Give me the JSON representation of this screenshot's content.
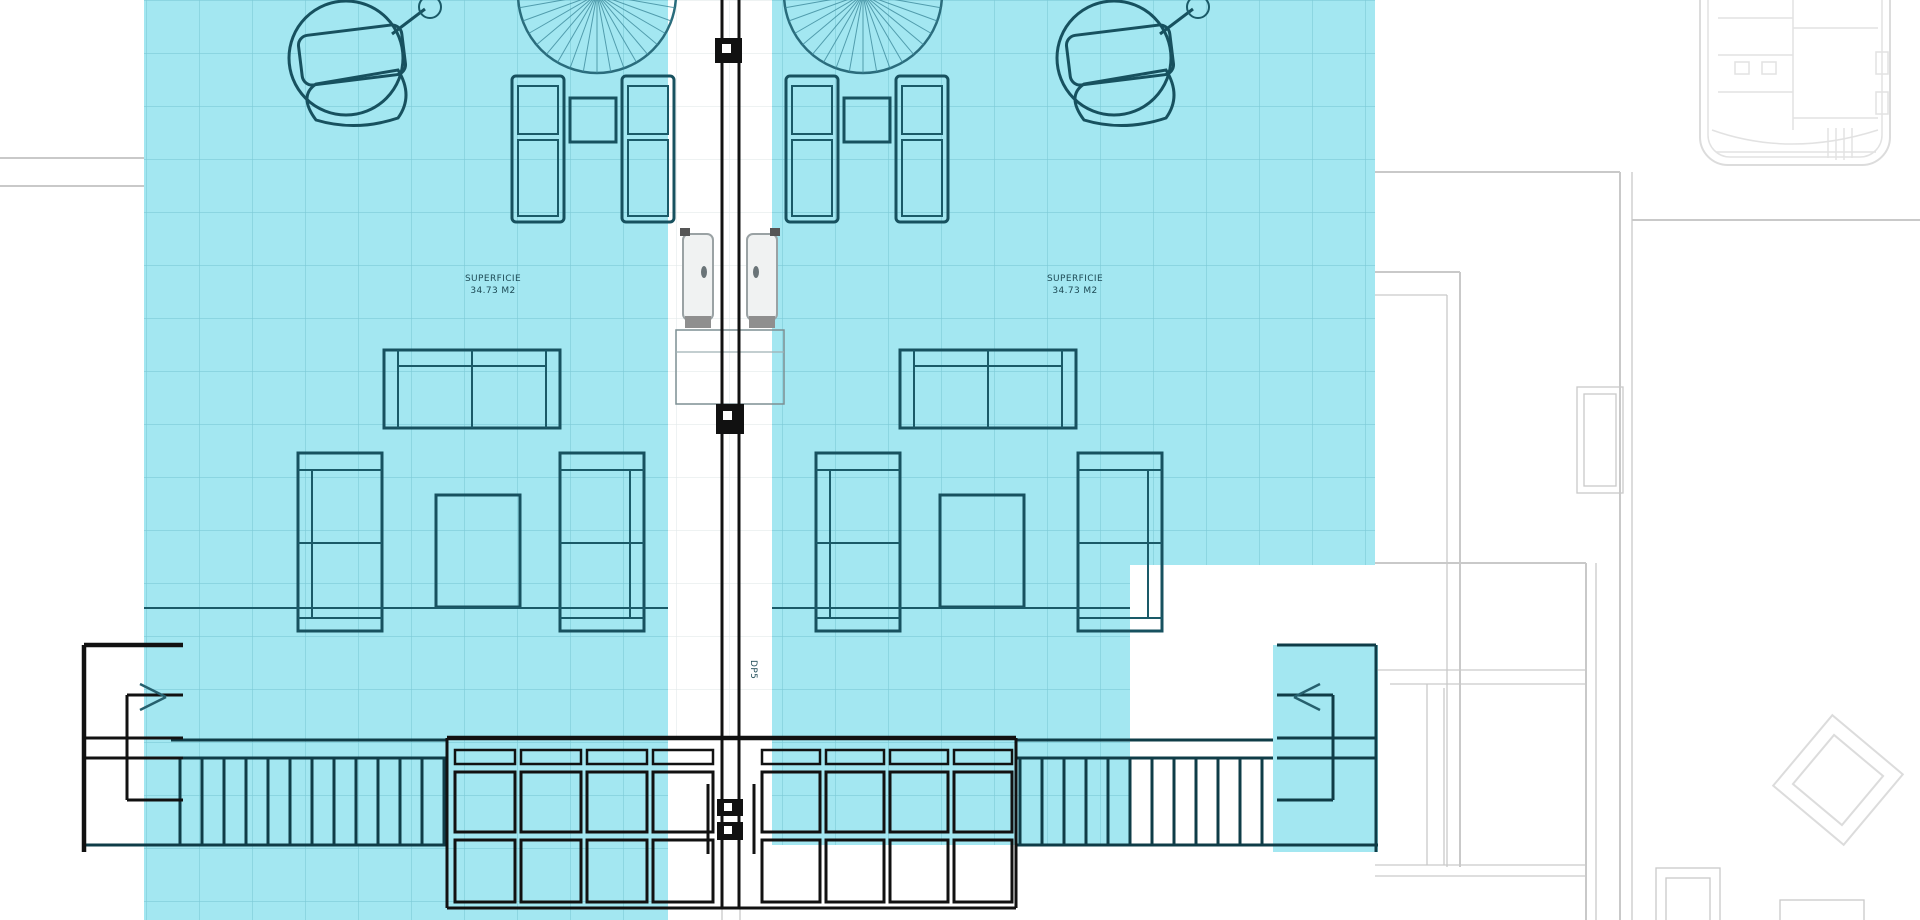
{
  "document": {
    "type": "architectural-floor-plan",
    "view": "terrace-solarium-plan",
    "units": 2
  },
  "labels": {
    "unit_left_area": {
      "line1": "SUPERFICIE",
      "line2": "34.73 M2"
    },
    "unit_right_area": {
      "line1": "SUPERFICIE",
      "line2": "34.73 M2"
    },
    "wall_mark": "DP5"
  },
  "colors": {
    "highlight_cyan": "#a3e7f1",
    "tile_grid_line": "#55aebd",
    "furniture_line": "#17515f",
    "railing_line": "#0f3c47",
    "wall_line": "#111111",
    "neighbor_line": "#c9c9c9",
    "door_fill": "#f0f2f2",
    "background": "#ffffff"
  }
}
